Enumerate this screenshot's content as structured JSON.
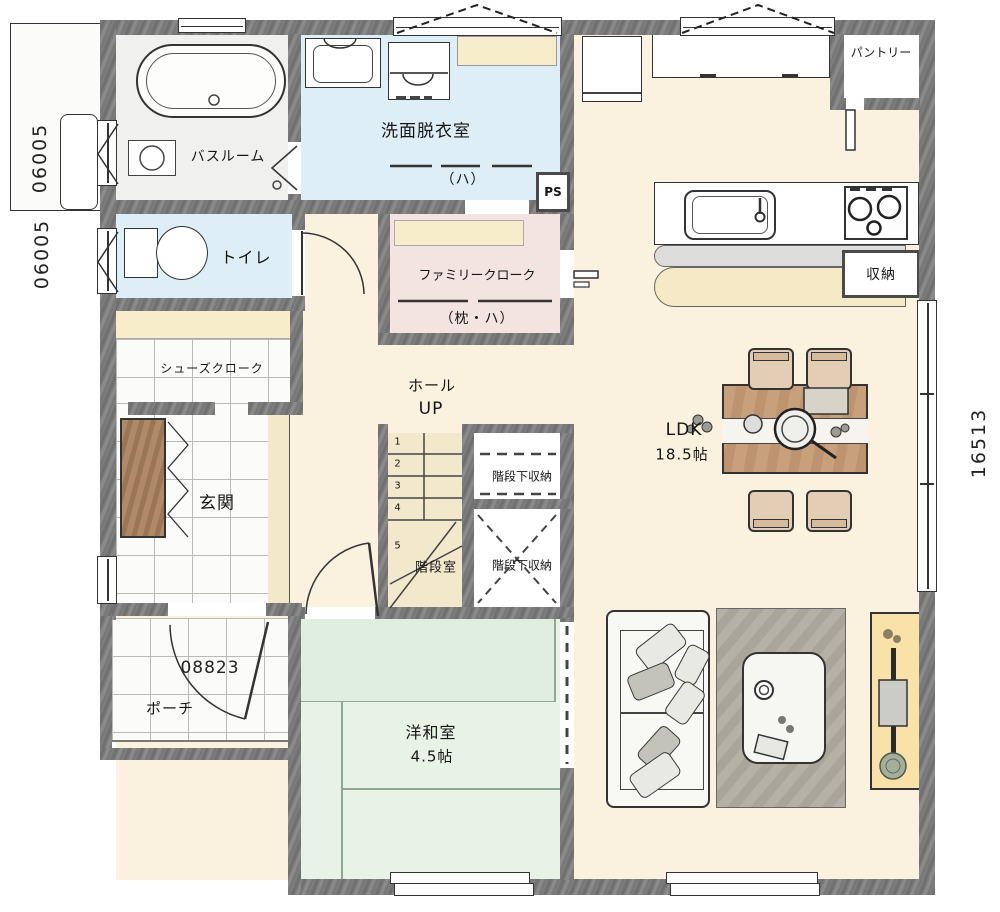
{
  "labels": {
    "bathroom": "バスルーム",
    "washroom": "洗面脱衣室",
    "washroom_note": "（ハ）",
    "toilet": "トイレ",
    "shoe_closet": "シューズクローク",
    "entrance": "玄関",
    "porch": "ポーチ",
    "hall": "ホール",
    "up": "UP",
    "stair_room": "階段室",
    "under_stairs_storage_upper": "階段下収納",
    "under_stairs_storage_lower": "階段下収納",
    "family_closet": "ファミリークローク",
    "family_closet_note": "（枕・ハ）",
    "ldk_name": "LDK",
    "ldk_size": "18.5帖",
    "japanese_room": "洋和室",
    "japanese_room_size": "4.5帖",
    "kitchen_storage": "収納",
    "pantry": "パントリー",
    "pipe_space": "PS"
  },
  "dimensions": {
    "left_upper": "06005",
    "left_lower": "06005",
    "porch": "08823",
    "right_side": "16513"
  },
  "stairs": {
    "steps": [
      "1",
      "2",
      "3",
      "4",
      "5"
    ]
  },
  "colors": {
    "wall": "#707070",
    "floor_cream": "#faf2df",
    "floor_blue": "#ddeef6",
    "floor_green": "#e9f2e7",
    "floor_pink": "#f3e4e1",
    "shelf_beige": "#f7edca",
    "counter_beige": "#f5e9c6",
    "tv_board_yellow": "#f8e2a7",
    "table_wood": "#c79d79"
  }
}
